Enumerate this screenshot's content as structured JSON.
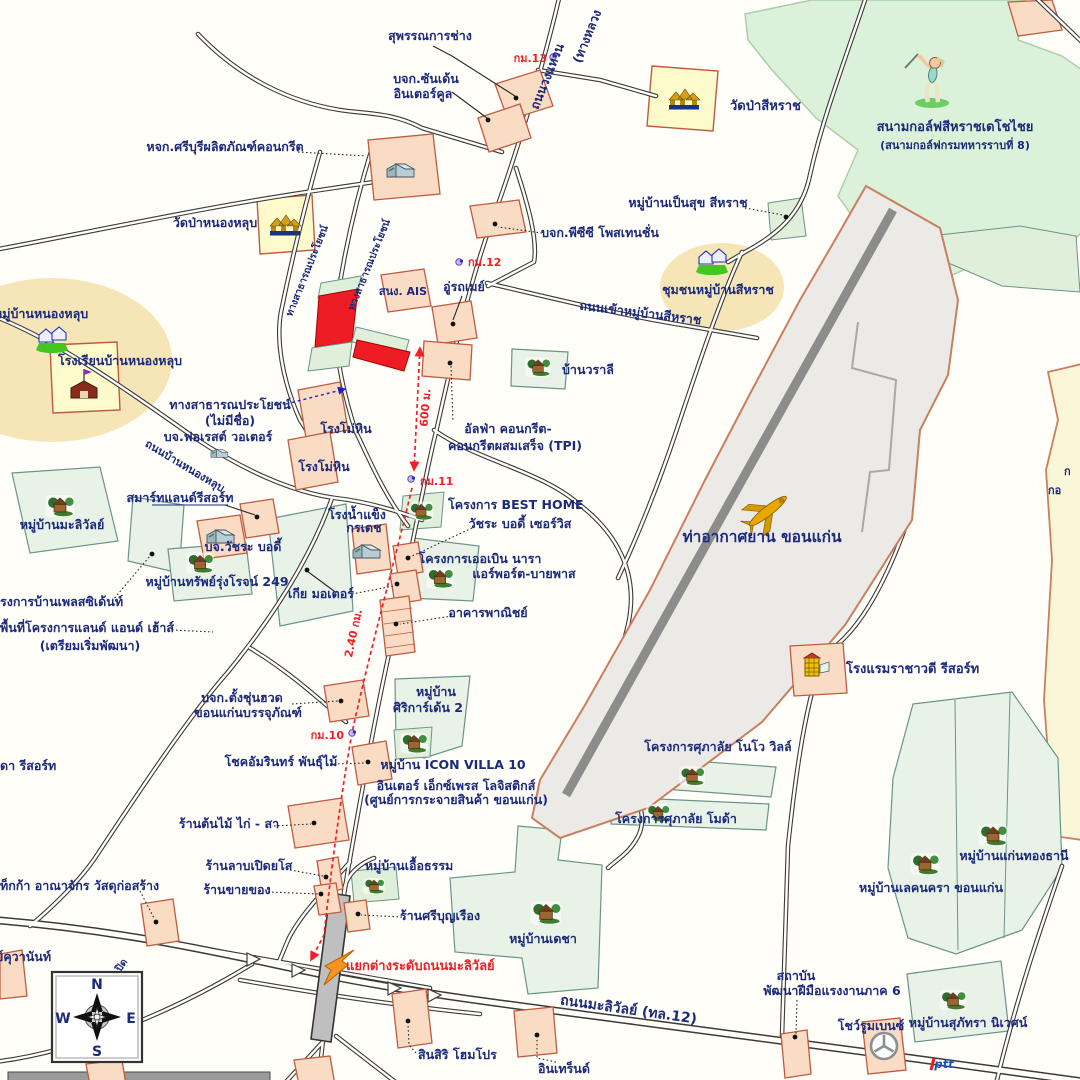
{
  "labels": {
    "suphankarnchang": "สุพรรณการช่าง",
    "sunden1": "บจก.ซันเด้น",
    "sunden2": "อินเตอร์คูล",
    "ringroad": "ถนนวงแหวน",
    "ringroad2": "(ทางหลวง",
    "watpasiharat": "วัดป่าสีหราช",
    "golfname1": "สนามกอล์ฟสีหราชเดโชไชย",
    "golfname2": "(สนามกอล์ฟกรมทหารราบที่ 8)",
    "sriburi": "หจก.ศรีบุรีผลิตภัณฑ์คอนกรีต",
    "watpanonglub": "วัดป่าหนองหลุบ",
    "pensuk": "หมู่บ้านเป็นสุข สีหราช",
    "pcc": "บจก.พีซีซี โพสเทนชั่น",
    "chumchon": "ชุมชนหมู่บ้านสีหราช",
    "rdsiharat": "ถนนเข้าหมู่บ้านสีหราช",
    "ais": "สนง. AIS",
    "garage": "อู่รถเมย์",
    "nonglubvillage": "หมู่บ้านหนองหลุบ",
    "school": "โรงเรียนบ้านหนองหลุบ",
    "waralee": "บ้านวราลี",
    "pubroad": "ทางสาธารณประโยชน์",
    "pubnoname1": "ทางสาธารณประโยชน์",
    "pubnoname2": "(ไม่มีชื่อ)",
    "forest": "บจ.ฟอเรสต์ วอเตอร์",
    "mohin1": "โรงโม่หิน",
    "mohin2": "โรงโม่หิน",
    "rdnonglub": "ถนนบ้านหนองหลุบ",
    "alp1": "อัลฟ่า คอนกรีต-",
    "alp2": "คอนกรีตผสมเสร็จ (TPI)",
    "smartland": "สมาร์ทแลนด์รีสอร์ท",
    "malivanvillage": "หมู่บ้านมะลิวัลย์",
    "watchara": "บจ.วัชระ บอดี้",
    "ice1": "โรงน้ำแข็ง",
    "ice2": "กรเดช",
    "sap249": "หมู่บ้านทรัพย์รุ่งโรจน์ 249",
    "kia": "เกีย มอเตอร์",
    "president": "รงการบ้านเพลสซิเด้นท์",
    "landhouse1": "พื้นที่โครงการแลนด์ แอนด์ เฮ้าส์",
    "landhouse2": "(เตรียมเริ่มพัฒนา)",
    "besthome": "โครงการ BEST HOME",
    "watcharaservice": "วัชระ บอดี้ เซอร์วิส",
    "urban1": "โครงการเออเบิน นารา",
    "urban2": "แอร์พอร์ต-บายพาส",
    "commercial": "อาคารพาณิชย์",
    "siri1": "หมู่บ้าน",
    "siri2": "ศิริการ์เด้น 2",
    "iconvilla": "หมู่บ้าน ICON VILLA 10",
    "express1": "อินเตอร์ เอ็กซ์เพรส โลจิสติกส์",
    "express2": "(ศูนย์การกระจายสินค้า ขอนแก่น)",
    "chokamarin": "โชคอัมรินทร์ พันธุ์ไม้",
    "tangchun1": "บจก.ตั้งชุ่นฮวด",
    "tangchun2": "ขอนแก่นบรรจุภัณฑ์",
    "ladda": "ดา รีสอร์ท",
    "tonmai": "ร้านต้นไม้ ไก่ - สา",
    "lab": "ร้านลาบเปิดยโส",
    "shop": "ร้านขายของ",
    "mega": "ท็กก้า อาณาจักร วัสดุก่อสร้าง",
    "ueatham": "หมู่บ้านเอื้อธรรม",
    "sriboonruang": "ร้านศรีบุญเรือง",
    "decha": "หมู่บ้านเดชา",
    "rachawadee": "โรงแรมราชาวดี รีสอร์ท",
    "novo": "โครงการศุภาลัย โนโว วิลล์",
    "moda": "โครงการศุภาลัย โมด้า",
    "kaenthong": "หมู่บ้านแก่นทองธานี",
    "lakenakara": "หมู่บ้านเลคนครา ขอนแก่น",
    "inst1": "สถาบัน",
    "inst2": "พัฒนาฝีมือแรงงานภาค 6",
    "benz": "โชว์รูมเบนซ์",
    "supatra": "หมู่บ้านสุภัทรา นิเวศน์",
    "highway": "ถนนมะลิวัลย์ (ทล.12)",
    "interchange": "แยกต่างระดับถนนมะลิวัลย์",
    "sinsiri": "สินสิริ โฮมโปร",
    "intrend": "อินเทร็นด์",
    "kuvanant": "ย์คุวานันท์",
    "pid": "ปิด",
    "airportname": "ท่าอากาศยาน ขอนแก่น",
    "clip1": "ก",
    "clip2": "กอ",
    "ptt": "ptt"
  },
  "markers": {
    "km13": "กม.13",
    "km12": "กม.12",
    "km11": "กม.11",
    "km10": "กม.10"
  },
  "measurements": {
    "m600": "600 ม.",
    "m240": "2.40 กม."
  },
  "compass": {
    "n": "N",
    "e": "E",
    "s": "S",
    "w": "W"
  },
  "colors": {
    "background": "#FFFEF9",
    "label_navy": "#1B2A7B",
    "measure_red": "#F01E28",
    "arrow_orange": "#F7941D",
    "road_casing": "#3A3A3A",
    "apron": "#ECEAE7",
    "runway_gray": "#8C8C8C",
    "golf_green": "#DCF1DA",
    "village_green": "#E9F2E6",
    "parcel_fill": "#F9DCC3",
    "parcel_border": "#C05A41",
    "subject_red": "#EE1C25",
    "temple_yellow": "#FDFACC",
    "ellipse_tan": "#F3DFA6",
    "yellow_area": "#FAF7D9"
  }
}
